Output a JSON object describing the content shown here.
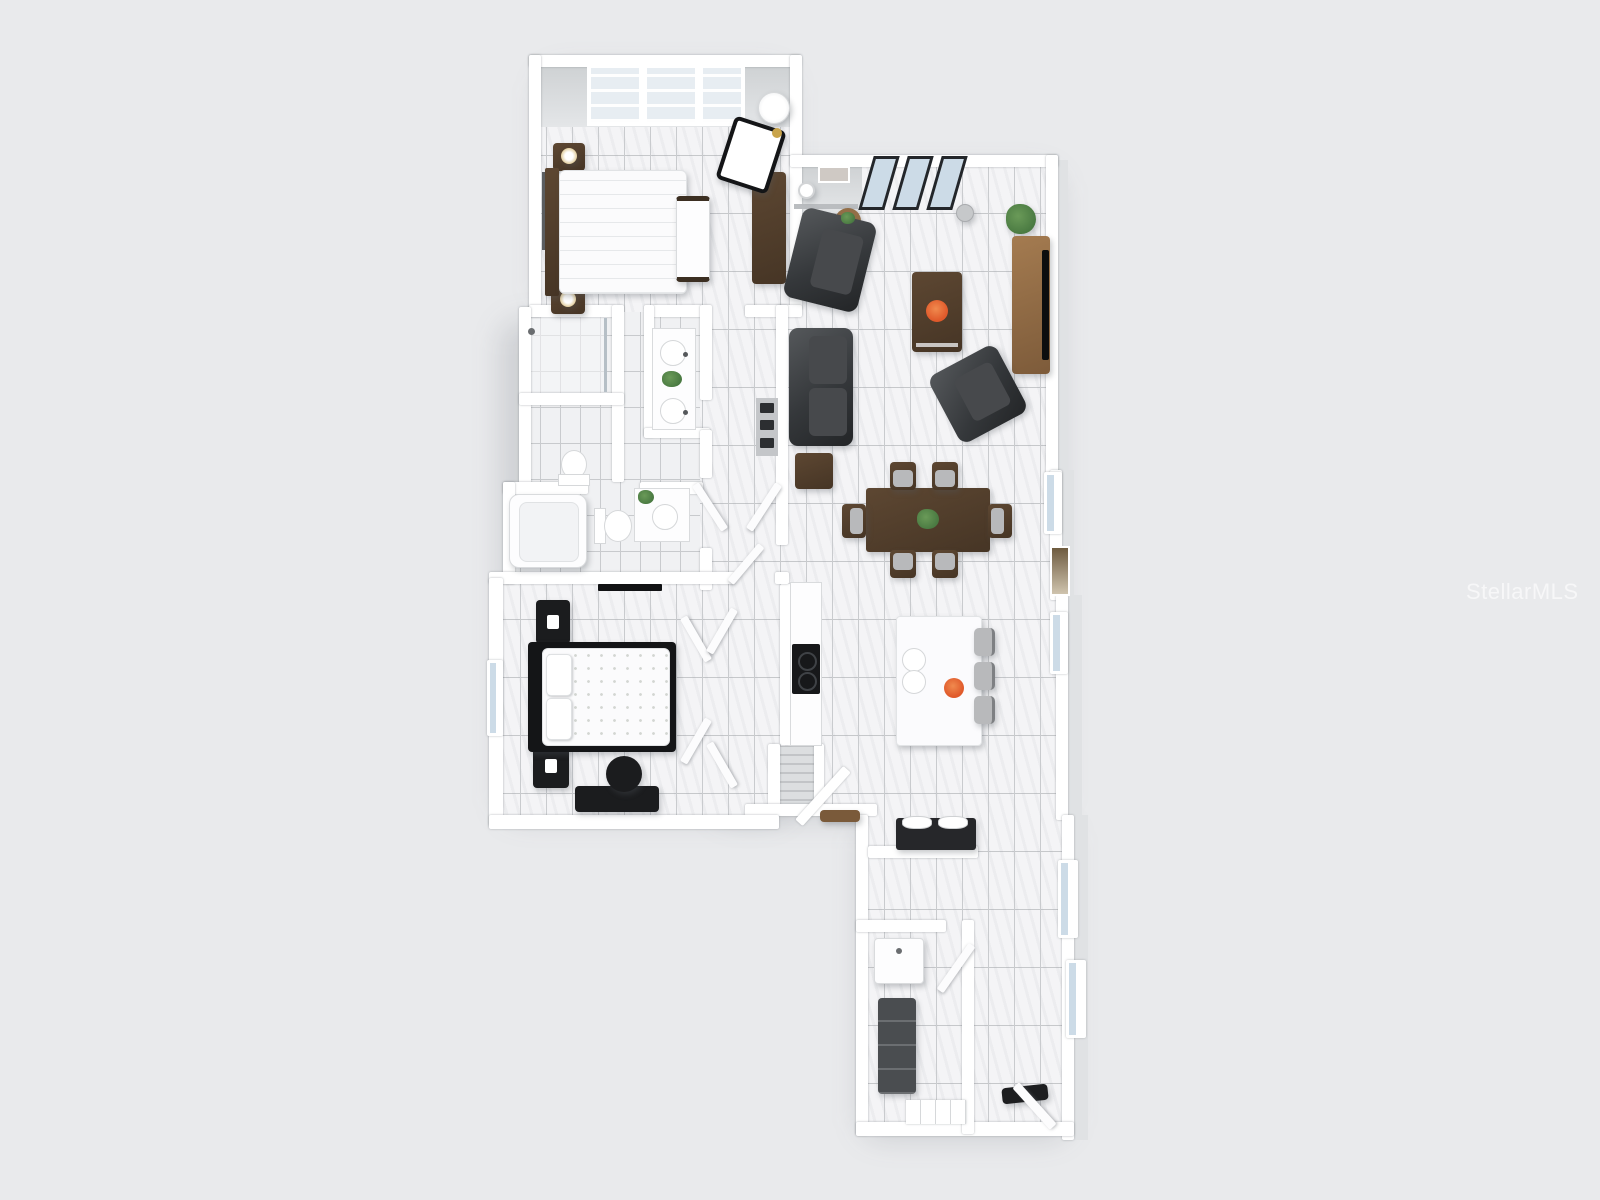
{
  "image": {
    "kind": "3d-rendered-floor-plan",
    "description_visible_content": "Top-down 3D rendering of a single-story home floor plan on a plain light-gray background, no room labels or dimensions shown",
    "width_px": 1600,
    "height_px": 1200
  },
  "watermark": {
    "text": "StellarMLS"
  },
  "colors": {
    "background": "#e9eaec",
    "wall": "#ffffff",
    "wall_shade": "#d7d9db",
    "wall_face": "#cfd2d4",
    "floor": "#f4f4f6",
    "floor_bath": "#f0f1f3",
    "grout": "#c9cbce",
    "sofa": "#3a3d40",
    "wood_dark": "#4e3b2a",
    "wood_medium": "#936e47",
    "wood_light": "#7a5a3a",
    "black_furniture": "#1b1c1e",
    "island": "#fbfbfd",
    "stool": "#b8b9bb",
    "accent_orange": "#e05a2b",
    "plant_green": "#4a7a42",
    "glass_blue": "#ccdbe7",
    "glass_pale": "#e7edf2",
    "lamp_gold": "#c9a44b",
    "watermark": "rgba(255,255,255,0.62)"
  }
}
